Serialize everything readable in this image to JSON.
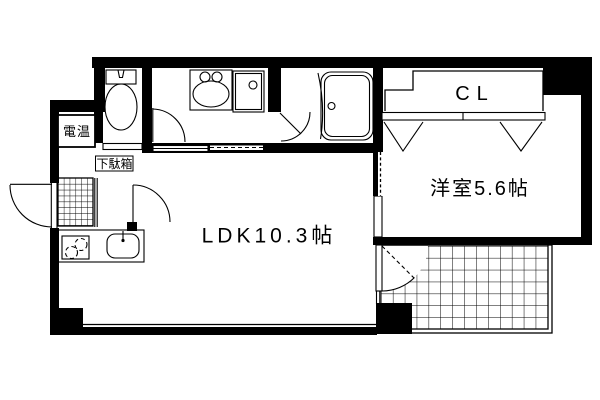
{
  "floorplan": {
    "labels": {
      "ldk": "LDK10.3帖",
      "western_room": "洋室5.6帖",
      "closet": "CL",
      "water_heater": "電温",
      "shoe_cabinet": "下駄箱"
    },
    "colors": {
      "wall": "#000000",
      "background": "#ffffff",
      "line": "#000000"
    }
  }
}
